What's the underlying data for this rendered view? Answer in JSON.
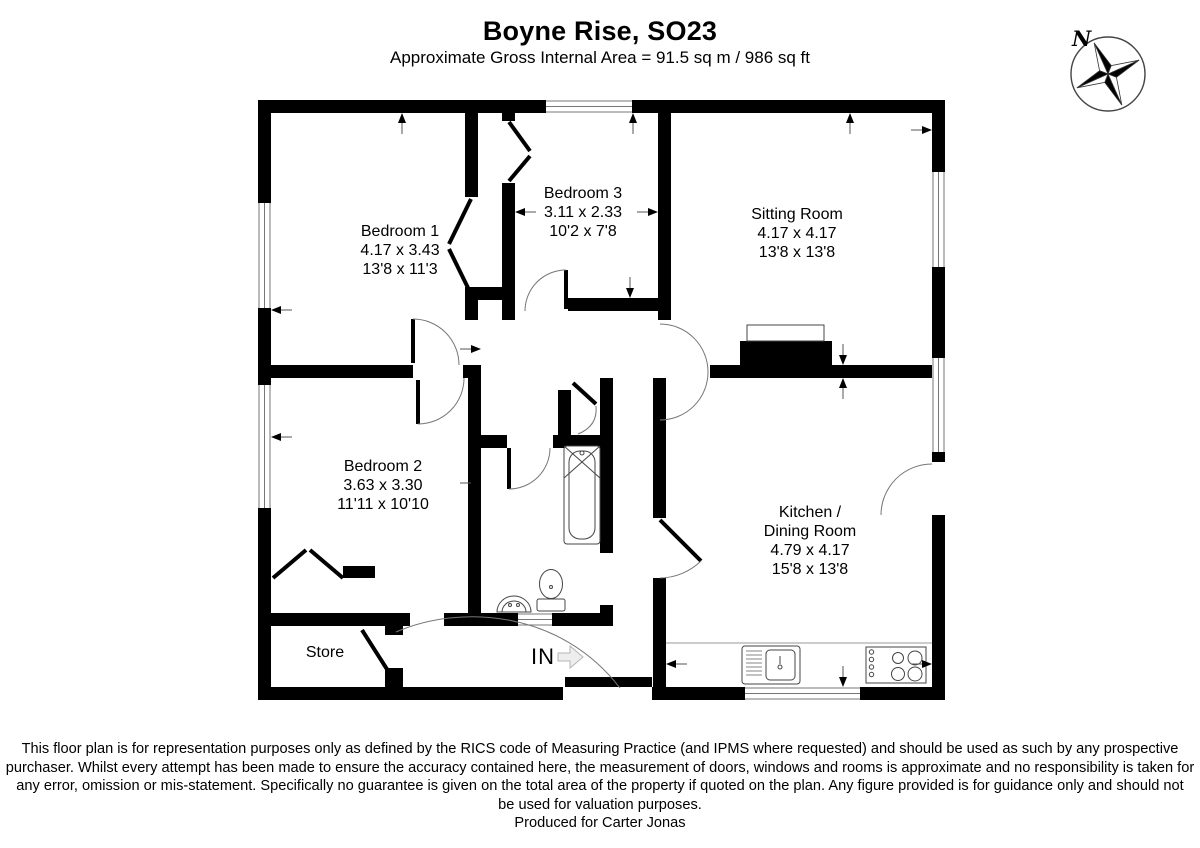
{
  "title": "Boyne Rise, SO23",
  "subtitle": "Approximate Gross Internal Area = 91.5 sq m / 986 sq ft",
  "compass": {
    "north_label": "N"
  },
  "entrance_label": "IN",
  "rooms": {
    "bedroom1": {
      "name": "Bedroom 1",
      "metric": "4.17 x 3.43",
      "imperial": "13'8 x 11'3"
    },
    "bedroom3": {
      "name": "Bedroom 3",
      "metric": "3.11 x 2.33",
      "imperial": "10'2 x 7'8"
    },
    "sitting_room": {
      "name": "Sitting Room",
      "metric": "4.17 x 4.17",
      "imperial": "13'8 x 13'8"
    },
    "bedroom2": {
      "name": "Bedroom 2",
      "metric": "3.63 x 3.30",
      "imperial": "11'11 x 10'10"
    },
    "kitchen": {
      "name_line1": "Kitchen /",
      "name_line2": "Dining Room",
      "metric": "4.79 x 4.17",
      "imperial": "15'8 x 13'8"
    },
    "store": {
      "name": "Store"
    }
  },
  "footer": {
    "lines": [
      "This floor plan is for representation purposes only as defined by the RICS code of Measuring Practice (and IPMS where requested) and should be used as such by any prospective",
      "purchaser. Whilst every attempt has been made to ensure the accuracy contained here, the measurement of doors, windows and rooms is approximate and no responsibility is taken for",
      "any error, omission or mis-statement. Specifically no guarantee is given on the total area of the property if quoted on the plan. Any figure provided is for guidance only and should not",
      "be used for valuation purposes.",
      "Produced for Carter Jonas"
    ]
  }
}
